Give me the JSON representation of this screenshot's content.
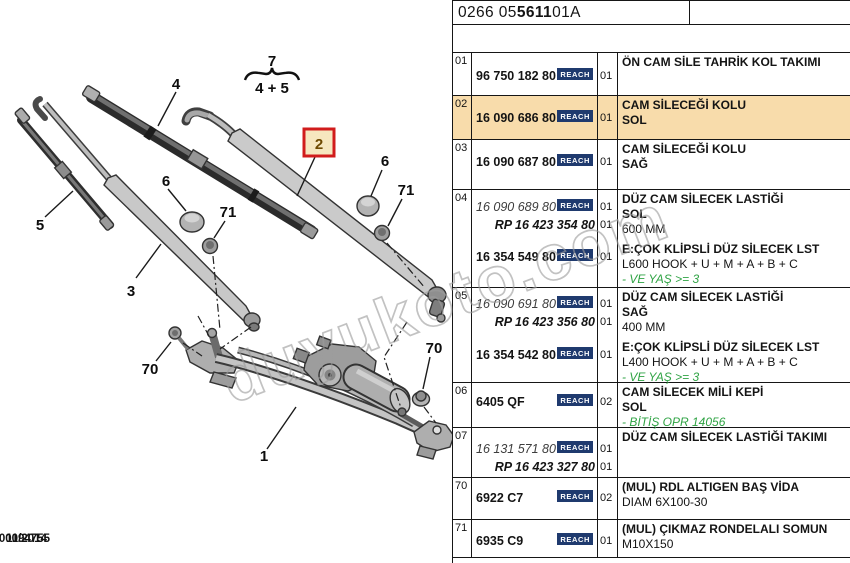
{
  "header": {
    "code_prefix": "0266 05 ",
    "code_bold": "5611",
    "code_suffix": " 01A"
  },
  "footer": {
    "date": "11/2014",
    "doc_number": "00094755"
  },
  "watermark": {
    "text": "duyukoto.com"
  },
  "reach_label": "REACH",
  "diagram": {
    "callouts": {
      "group_top": "7",
      "group_bottom": "4 + 5",
      "blade_large": "4",
      "blade_small": "5",
      "arm_left": "3",
      "arm_right": "2",
      "cap": "6",
      "nut": "71",
      "bolt": "70",
      "assembly": "1"
    }
  },
  "table": {
    "rows": [
      {
        "idx": "01",
        "hl": false,
        "parts": [
          {
            "num": "96 750 182 80",
            "style": "bold",
            "reach": true,
            "qty": "01"
          }
        ],
        "desc": [
          {
            "t": "ÖN CAM SİLE TAHRİK KOL TAKIMI",
            "s": "b"
          }
        ]
      },
      {
        "idx": "02",
        "hl": true,
        "parts": [
          {
            "num": "16 090 686 80",
            "style": "bold",
            "reach": true,
            "qty": "01"
          }
        ],
        "desc": [
          {
            "t": "CAM SİLECEĞİ KOLU",
            "s": "b"
          },
          {
            "t": "SOL",
            "s": "b"
          }
        ]
      },
      {
        "idx": "03",
        "hl": false,
        "parts": [
          {
            "num": "16 090 687 80",
            "style": "bold",
            "reach": true,
            "qty": "01"
          }
        ],
        "desc": [
          {
            "t": "CAM SİLECEĞİ KOLU",
            "s": "b"
          },
          {
            "t": "SAĞ",
            "s": "b"
          }
        ]
      },
      {
        "idx": "04",
        "hl": false,
        "parts": [
          {
            "num": "16 090 689 80",
            "style": "italic",
            "reach": true,
            "qty": "01"
          },
          {
            "num": "RP 16 423 354 80",
            "style": "rp",
            "qty": "01"
          },
          {
            "num": "16 354 549 80",
            "style": "bold",
            "reach": true,
            "qty": "01"
          }
        ],
        "desc": [
          {
            "t": "DÜZ CAM SİLECEK LASTİĞİ",
            "s": "b"
          },
          {
            "t": "SOL",
            "s": "b"
          },
          {
            "t": "600 MM",
            "s": "r"
          },
          {
            "t": "E:ÇOK KLİPSLİ DÜZ SİLECEK LST",
            "s": "b",
            "gap": true
          },
          {
            "t": "L600 HOOK + U + M + A + B + C",
            "s": "r"
          },
          {
            "t": "- VE YAŞ >= 3",
            "s": "g"
          }
        ]
      },
      {
        "idx": "05",
        "hl": false,
        "parts": [
          {
            "num": "16 090 691 80",
            "style": "italic",
            "reach": true,
            "qty": "01"
          },
          {
            "num": "RP 16 423 356 80",
            "style": "rp",
            "qty": "01"
          },
          {
            "num": "16 354 542 80",
            "style": "bold",
            "reach": true,
            "qty": "01"
          }
        ],
        "desc": [
          {
            "t": "DÜZ CAM SİLECEK LASTİĞİ",
            "s": "b"
          },
          {
            "t": "SAĞ",
            "s": "b"
          },
          {
            "t": "400 MM",
            "s": "r"
          },
          {
            "t": "E:ÇOK KLİPSLİ DÜZ SİLECEK LST",
            "s": "b",
            "gap": true
          },
          {
            "t": "L400 HOOK + U + M + A + B + C",
            "s": "r"
          },
          {
            "t": "- VE YAŞ >= 3",
            "s": "g"
          }
        ]
      },
      {
        "idx": "06",
        "hl": false,
        "parts": [
          {
            "num": "6405 QF",
            "style": "bold",
            "reach": true,
            "qty": "02"
          }
        ],
        "desc": [
          {
            "t": "CAM SİLECEK MİLİ KEPİ",
            "s": "b"
          },
          {
            "t": "SOL",
            "s": "b"
          },
          {
            "t": "- BİTİŞ OPR 14056",
            "s": "g"
          }
        ]
      },
      {
        "idx": "07",
        "hl": false,
        "parts": [
          {
            "num": "16 131 571 80",
            "style": "italic",
            "reach": true,
            "qty": "01"
          },
          {
            "num": "RP 16 423 327 80",
            "style": "rp",
            "qty": "01"
          }
        ],
        "desc": [
          {
            "t": "DÜZ CAM SİLECEK LASTİĞİ TAKIMI",
            "s": "b"
          }
        ]
      },
      {
        "idx": "70",
        "hl": false,
        "parts": [
          {
            "num": "6922 C7",
            "style": "bold",
            "reach": true,
            "qty": "02"
          }
        ],
        "desc": [
          {
            "t": "(MUL) RDL ALTIGEN BAŞ VİDA",
            "s": "b"
          },
          {
            "t": "DIAM 6X100-30",
            "s": "r"
          }
        ]
      },
      {
        "idx": "71",
        "hl": false,
        "parts": [
          {
            "num": "6935 C9",
            "style": "bold",
            "reach": true,
            "qty": "01"
          }
        ],
        "desc": [
          {
            "t": "(MUL) ÇIKMAZ RONDELALI SOMUN",
            "s": "b"
          },
          {
            "t": "M10X150",
            "s": "r"
          }
        ]
      }
    ]
  }
}
